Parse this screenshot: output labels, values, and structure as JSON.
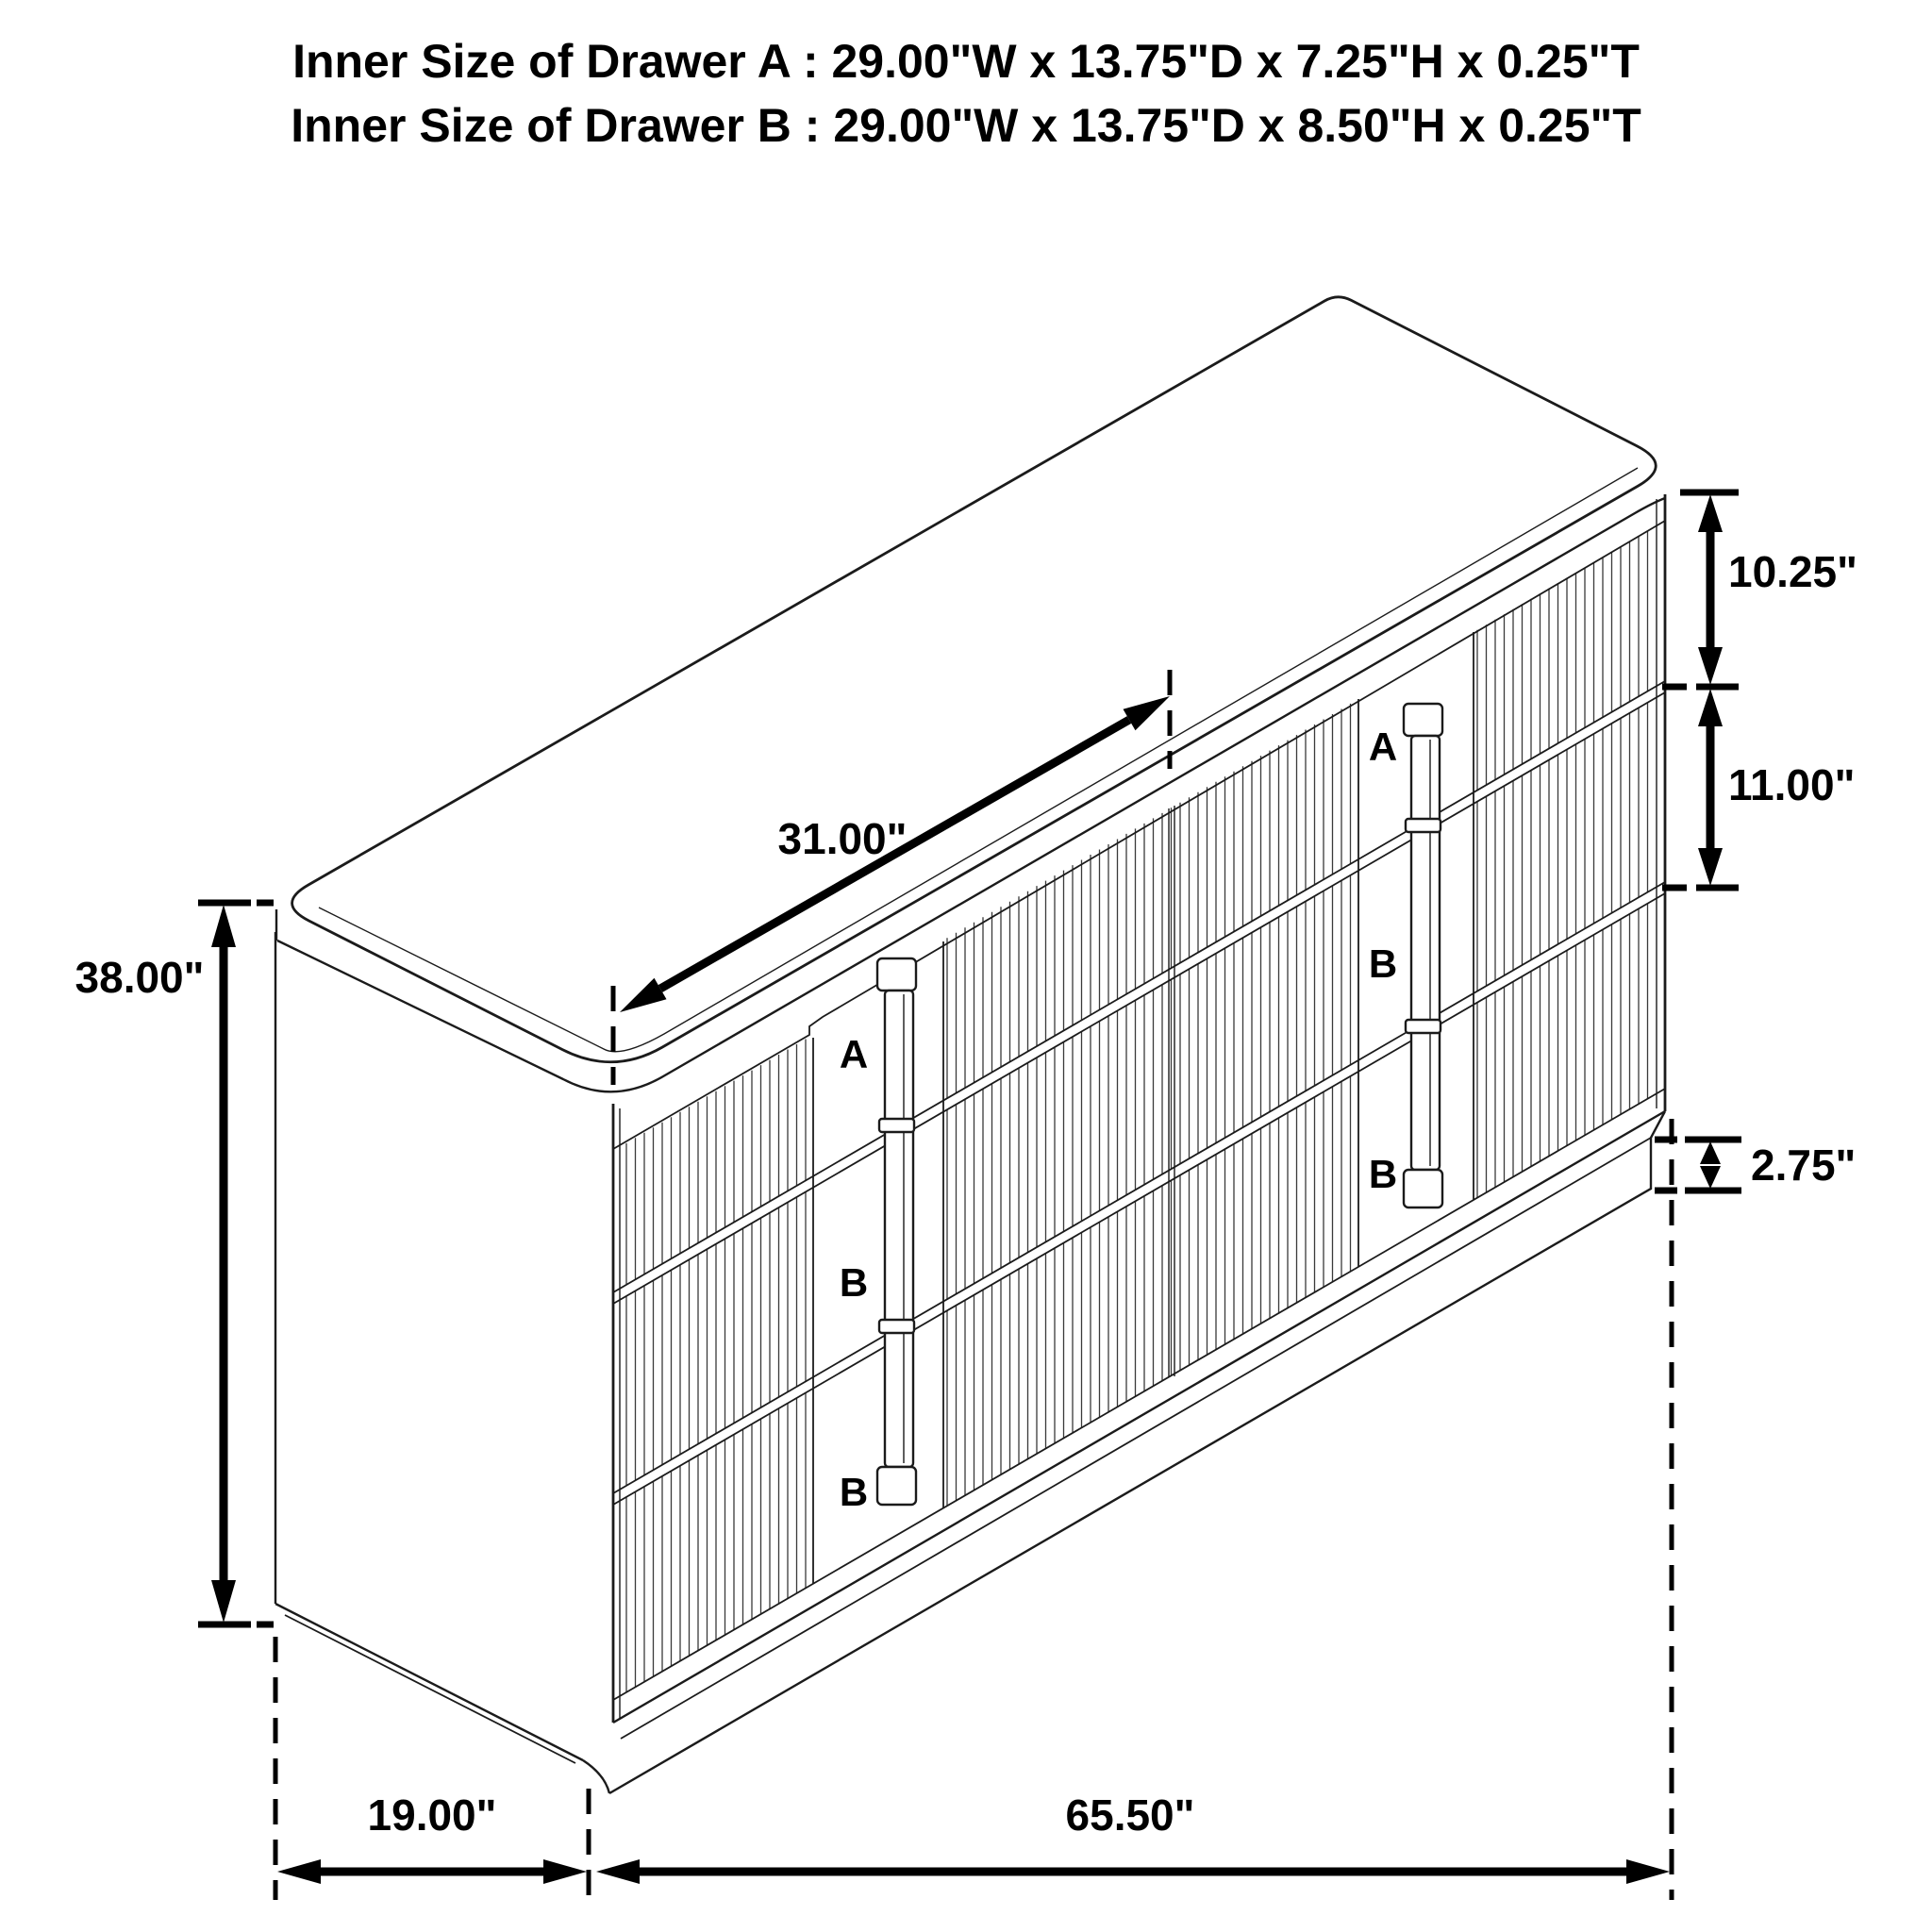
{
  "title": {
    "line1": "Inner Size of Drawer A : 29.00\"W x 13.75\"D x 7.25\"H x 0.25\"T",
    "line2": "Inner Size of Drawer B : 29.00\"W x 13.75\"D x 8.50\"H x 0.25\"T"
  },
  "dimensions": {
    "height": "38.00\"",
    "depth": "19.00\"",
    "width": "65.50\"",
    "drawer_span": "31.00\"",
    "top_drawer_height": "10.25\"",
    "middle_drawer_height": "11.00\"",
    "base_height": "2.75\""
  },
  "drawer_labels": {
    "left_column": [
      "A",
      "B",
      "B"
    ],
    "right_column": [
      "A",
      "B",
      "B"
    ]
  },
  "colors": {
    "label_red": "#e01b24",
    "line_black": "#000000",
    "background": "#ffffff"
  }
}
